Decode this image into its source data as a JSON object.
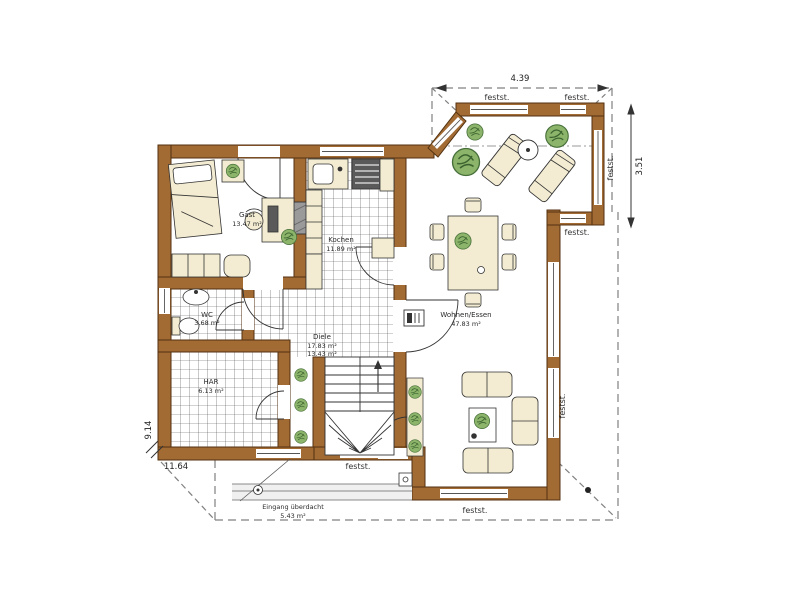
{
  "drawing": {
    "type": "floor-plan",
    "wall_color": "#a26b34",
    "tile_line_color": "#4a4a4a",
    "plant_color": "#8cb46a",
    "furniture_color": "#f3ecd2"
  },
  "rooms": {
    "gast": {
      "name": "Gast",
      "area": "13.47 m²"
    },
    "kochen": {
      "name": "Kochen",
      "area": "11.89 m²"
    },
    "wc": {
      "name": "WC",
      "area": "3.68 m²"
    },
    "har": {
      "name": "HAR",
      "area": "6.13 m²"
    },
    "diele": {
      "name": "Diele",
      "area1": "17.83 m²",
      "area2": "13.43 m²"
    },
    "wohnen": {
      "name": "Wohnen/Essen",
      "area": "47.83 m²"
    },
    "eingang": {
      "name": "Eingang überdacht",
      "area": "5.43 m²"
    }
  },
  "labels": {
    "fixed_glazing": "festst."
  },
  "dimensions": {
    "top_width": "4.39",
    "right_height": "3.51",
    "left_height": "9.14",
    "bottom_width": "11.64"
  }
}
